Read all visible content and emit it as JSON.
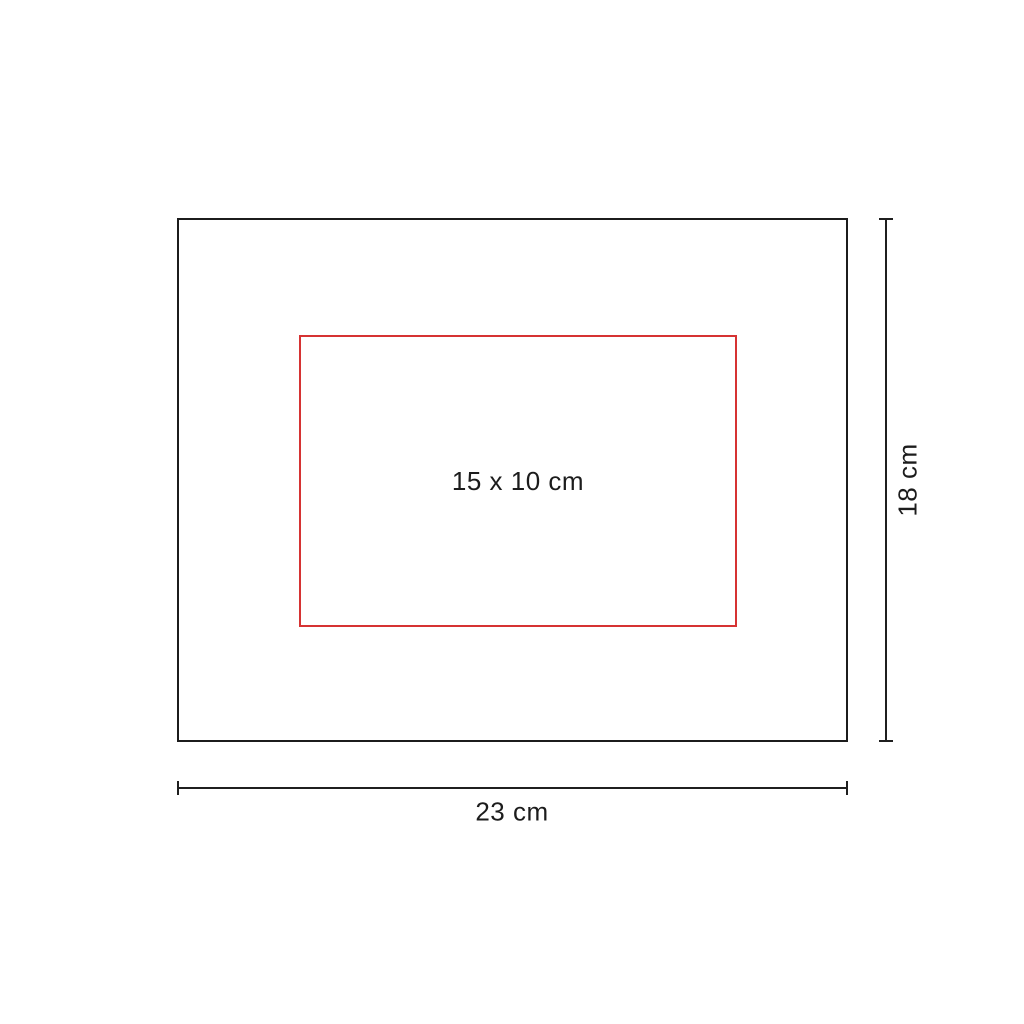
{
  "diagram": {
    "background": "#ffffff",
    "outline_color": "#1c1c1c",
    "product_outline": {
      "width_cm": 23,
      "height_cm": 18
    },
    "print_area": {
      "label": "15 x 10 cm",
      "color": "#d63333",
      "width_cm": 15,
      "height_cm": 10
    },
    "dimensions": {
      "height": {
        "label": "18 cm"
      },
      "width": {
        "label": "23 cm"
      }
    }
  }
}
